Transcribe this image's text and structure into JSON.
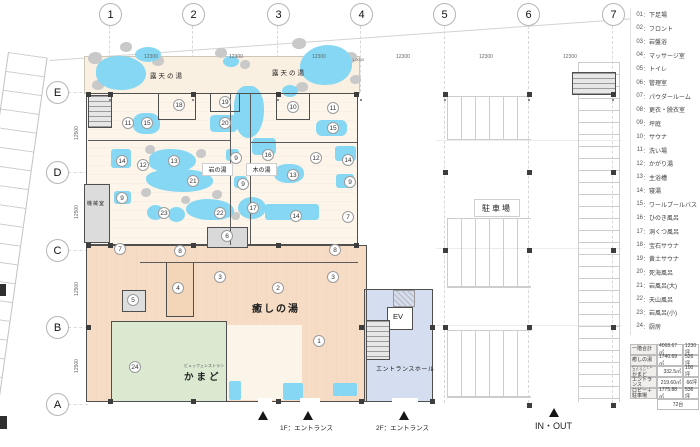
{
  "grid": {
    "cols": [
      "1",
      "2",
      "3",
      "4",
      "5",
      "6",
      "7"
    ],
    "rows": [
      "E",
      "D",
      "C",
      "B",
      "A"
    ],
    "col_dim": "12300",
    "row_dim": "12500",
    "extra_dim": "1,0000"
  },
  "labels": {
    "outdoor_bath": "露天の湯",
    "iwa_no_yu": "岩の湯",
    "ki_no_yu": "木の湯",
    "iyashi_no_yu": "癒しの湯",
    "kamado": "かまど",
    "kamado_ruby": "ビュッフェレストラン",
    "machine_room": "機械室",
    "parking": "駐車場",
    "entrance_hall": "エントランスホール",
    "ev": "EV"
  },
  "footer": {
    "entrance_1f": "1F：エントランス",
    "entrance_2f": "2F：エントランス",
    "inout": "IN・OUT"
  },
  "legend": {
    "sep": "：",
    "items": [
      {
        "num": "01",
        "label": "下足場"
      },
      {
        "num": "02",
        "label": "フロント"
      },
      {
        "num": "03",
        "label": "岩盤浴"
      },
      {
        "num": "04",
        "label": "マッサージ室"
      },
      {
        "num": "05",
        "label": "トイレ"
      },
      {
        "num": "06",
        "label": "管理室"
      },
      {
        "num": "07",
        "label": "パウダールーム"
      },
      {
        "num": "08",
        "label": "更衣・脱衣室"
      },
      {
        "num": "09",
        "label": "坪庭"
      },
      {
        "num": "10",
        "label": "サウナ"
      },
      {
        "num": "11",
        "label": "洗い場"
      },
      {
        "num": "12",
        "label": "かがり湯"
      },
      {
        "num": "13",
        "label": "主浴槽"
      },
      {
        "num": "14",
        "label": "寝湯"
      },
      {
        "num": "15",
        "label": "ワールプールバス"
      },
      {
        "num": "16",
        "label": "ひのき風呂"
      },
      {
        "num": "17",
        "label": "洞くつ風呂"
      },
      {
        "num": "18",
        "label": "宝石サウナ"
      },
      {
        "num": "19",
        "label": "黄土サウナ"
      },
      {
        "num": "20",
        "label": "死海風呂"
      },
      {
        "num": "21",
        "label": "岩風呂(大)"
      },
      {
        "num": "22",
        "label": "天山風呂"
      },
      {
        "num": "23",
        "label": "岩風呂(小)"
      },
      {
        "num": "24",
        "label": "厨房"
      }
    ]
  },
  "table": {
    "rows": [
      {
        "label": "一階合計",
        "ruby": "",
        "area": "4068.67㎡",
        "tsubo": "1230坪"
      },
      {
        "label": "癒しの湯",
        "ruby": "",
        "area": "1740.69㎡",
        "tsubo": "526坪"
      },
      {
        "label": "かまど",
        "ruby": "ビュッフェレストラン",
        "area": "332.5㎡",
        "tsubo": "100坪"
      },
      {
        "label": "エントランス",
        "ruby": "",
        "area": "219.60㎡",
        "tsubo": "66坪"
      },
      {
        "label": "ロビー＋駐車場",
        "ruby": "",
        "area": "1775.88㎡",
        "tsubo": "536坪"
      },
      {
        "label": "",
        "ruby": "",
        "area": "",
        "tsubo": "72台"
      }
    ]
  },
  "colors": {
    "water": "#85d7f3",
    "bath_floor": "#fdf5ea",
    "garden": "#faf0e1",
    "lobby": "#f7dcc5",
    "kitchen": "#dbe9d1",
    "entrance_hall": "#d5ddf0",
    "rock": "#c9c9c9",
    "wall": "#4f4f4f"
  },
  "plan": {
    "markers": [
      {
        "n": "18",
        "x": 179,
        "y": 105
      },
      {
        "n": "19",
        "x": 225,
        "y": 102
      },
      {
        "n": "20",
        "x": 225,
        "y": 123
      },
      {
        "n": "10",
        "x": 293,
        "y": 107
      },
      {
        "n": "11",
        "x": 333,
        "y": 108
      },
      {
        "n": "11",
        "x": 128,
        "y": 123
      },
      {
        "n": "15",
        "x": 147,
        "y": 123
      },
      {
        "n": "15",
        "x": 333,
        "y": 128
      },
      {
        "n": "14",
        "x": 122,
        "y": 161
      },
      {
        "n": "12",
        "x": 143,
        "y": 165
      },
      {
        "n": "13",
        "x": 174,
        "y": 161
      },
      {
        "n": "16",
        "x": 268,
        "y": 155
      },
      {
        "n": "9",
        "x": 236,
        "y": 158
      },
      {
        "n": "12",
        "x": 316,
        "y": 158
      },
      {
        "n": "14",
        "x": 348,
        "y": 160
      },
      {
        "n": "13",
        "x": 293,
        "y": 175
      },
      {
        "n": "21",
        "x": 193,
        "y": 181
      },
      {
        "n": "9",
        "x": 243,
        "y": 184
      },
      {
        "n": "9",
        "x": 350,
        "y": 182
      },
      {
        "n": "9",
        "x": 122,
        "y": 198
      },
      {
        "n": "23",
        "x": 164,
        "y": 213
      },
      {
        "n": "22",
        "x": 220,
        "y": 213
      },
      {
        "n": "17",
        "x": 253,
        "y": 208
      },
      {
        "n": "14",
        "x": 296,
        "y": 216
      },
      {
        "n": "7",
        "x": 348,
        "y": 217
      },
      {
        "n": "7",
        "x": 120,
        "y": 249
      },
      {
        "n": "8",
        "x": 180,
        "y": 251
      },
      {
        "n": "6",
        "x": 227,
        "y": 236
      },
      {
        "n": "8",
        "x": 335,
        "y": 250
      },
      {
        "n": "3",
        "x": 220,
        "y": 277
      },
      {
        "n": "4",
        "x": 178,
        "y": 288
      },
      {
        "n": "2",
        "x": 278,
        "y": 288
      },
      {
        "n": "3",
        "x": 333,
        "y": 277
      },
      {
        "n": "5",
        "x": 133,
        "y": 300
      },
      {
        "n": "24",
        "x": 135,
        "y": 367
      },
      {
        "n": "1",
        "x": 319,
        "y": 341
      }
    ],
    "pools": [
      {
        "x": 96,
        "y": 56,
        "w": 50,
        "h": 34,
        "r": "45% 55% 50% 50%"
      },
      {
        "x": 135,
        "y": 47,
        "w": 26,
        "h": 15,
        "r": "50%"
      },
      {
        "x": 223,
        "y": 56,
        "w": 16,
        "h": 11,
        "r": "50%"
      },
      {
        "x": 300,
        "y": 45,
        "w": 52,
        "h": 40,
        "r": "55% 45% 50% 45%"
      },
      {
        "x": 282,
        "y": 85,
        "w": 16,
        "h": 12,
        "r": "50%"
      },
      {
        "x": 133,
        "y": 113,
        "w": 27,
        "h": 21,
        "r": "40%"
      },
      {
        "x": 111,
        "y": 149,
        "w": 20,
        "h": 19,
        "r": "3px"
      },
      {
        "x": 149,
        "y": 149,
        "w": 47,
        "h": 23,
        "r": "45% 55% 50% 40%"
      },
      {
        "x": 146,
        "y": 169,
        "w": 67,
        "h": 23,
        "r": "40% 50% 45% 55%"
      },
      {
        "x": 210,
        "y": 115,
        "w": 27,
        "h": 17,
        "r": "4px"
      },
      {
        "x": 234,
        "y": 86,
        "w": 30,
        "h": 52,
        "r": "40% 45% 55% 50%"
      },
      {
        "x": 252,
        "y": 138,
        "w": 24,
        "h": 17,
        "r": "4px"
      },
      {
        "x": 274,
        "y": 164,
        "w": 30,
        "h": 19,
        "r": "45%"
      },
      {
        "x": 316,
        "y": 120,
        "w": 31,
        "h": 16,
        "r": "6px"
      },
      {
        "x": 335,
        "y": 146,
        "w": 21,
        "h": 15,
        "r": "3px"
      },
      {
        "x": 226,
        "y": 149,
        "w": 13,
        "h": 12,
        "r": "3px"
      },
      {
        "x": 234,
        "y": 176,
        "w": 13,
        "h": 12,
        "r": "3px"
      },
      {
        "x": 114,
        "y": 191,
        "w": 17,
        "h": 13,
        "r": "3px"
      },
      {
        "x": 336,
        "y": 174,
        "w": 18,
        "h": 14,
        "r": "3px"
      },
      {
        "x": 147,
        "y": 205,
        "w": 17,
        "h": 15,
        "r": "50%"
      },
      {
        "x": 168,
        "y": 207,
        "w": 17,
        "h": 15,
        "r": "50%"
      },
      {
        "x": 186,
        "y": 199,
        "w": 48,
        "h": 21,
        "r": "45% 55% 40% 50%"
      },
      {
        "x": 238,
        "y": 197,
        "w": 28,
        "h": 22,
        "r": "50%"
      },
      {
        "x": 265,
        "y": 204,
        "w": 54,
        "h": 16,
        "r": "3px"
      },
      {
        "x": 283,
        "y": 383,
        "w": 20,
        "h": 17,
        "r": "2px"
      },
      {
        "x": 333,
        "y": 383,
        "w": 24,
        "h": 13,
        "r": "2px"
      },
      {
        "x": 229,
        "y": 381,
        "w": 12,
        "h": 19,
        "r": "2px"
      }
    ],
    "rocks": [
      {
        "x": 88,
        "y": 52,
        "w": 14,
        "h": 12
      },
      {
        "x": 120,
        "y": 42,
        "w": 12,
        "h": 10
      },
      {
        "x": 152,
        "y": 56,
        "w": 12,
        "h": 10
      },
      {
        "x": 92,
        "y": 80,
        "w": 12,
        "h": 10
      },
      {
        "x": 215,
        "y": 48,
        "w": 12,
        "h": 10
      },
      {
        "x": 240,
        "y": 60,
        "w": 10,
        "h": 9
      },
      {
        "x": 292,
        "y": 38,
        "w": 14,
        "h": 11
      },
      {
        "x": 344,
        "y": 52,
        "w": 13,
        "h": 11
      },
      {
        "x": 296,
        "y": 82,
        "w": 12,
        "h": 10
      },
      {
        "x": 350,
        "y": 75,
        "w": 11,
        "h": 9
      },
      {
        "x": 246,
        "y": 92,
        "w": 12,
        "h": 10
      },
      {
        "x": 145,
        "y": 145,
        "w": 10,
        "h": 9
      },
      {
        "x": 196,
        "y": 149,
        "w": 10,
        "h": 9
      },
      {
        "x": 141,
        "y": 188,
        "w": 10,
        "h": 9
      },
      {
        "x": 212,
        "y": 190,
        "w": 10,
        "h": 9
      },
      {
        "x": 181,
        "y": 196,
        "w": 9,
        "h": 8
      },
      {
        "x": 231,
        "y": 212,
        "w": 9,
        "h": 8
      }
    ],
    "columns": [
      {
        "x": 86,
        "y": 92
      },
      {
        "x": 108,
        "y": 92
      },
      {
        "x": 191,
        "y": 92
      },
      {
        "x": 276,
        "y": 92
      },
      {
        "x": 354,
        "y": 92
      },
      {
        "x": 86,
        "y": 243
      },
      {
        "x": 108,
        "y": 243
      },
      {
        "x": 191,
        "y": 243
      },
      {
        "x": 276,
        "y": 243
      },
      {
        "x": 354,
        "y": 243
      },
      {
        "x": 86,
        "y": 325
      },
      {
        "x": 359,
        "y": 325
      },
      {
        "x": 430,
        "y": 325
      },
      {
        "x": 108,
        "y": 399
      },
      {
        "x": 191,
        "y": 399
      },
      {
        "x": 276,
        "y": 399
      },
      {
        "x": 359,
        "y": 399
      },
      {
        "x": 430,
        "y": 399
      },
      {
        "x": 443,
        "y": 92
      },
      {
        "x": 527,
        "y": 92
      },
      {
        "x": 611,
        "y": 92
      },
      {
        "x": 443,
        "y": 170
      },
      {
        "x": 527,
        "y": 170
      },
      {
        "x": 611,
        "y": 170
      },
      {
        "x": 443,
        "y": 248
      },
      {
        "x": 527,
        "y": 248
      },
      {
        "x": 611,
        "y": 248
      },
      {
        "x": 443,
        "y": 325
      },
      {
        "x": 527,
        "y": 325
      },
      {
        "x": 611,
        "y": 325
      },
      {
        "x": 527,
        "y": 403
      },
      {
        "x": 611,
        "y": 403
      }
    ]
  }
}
